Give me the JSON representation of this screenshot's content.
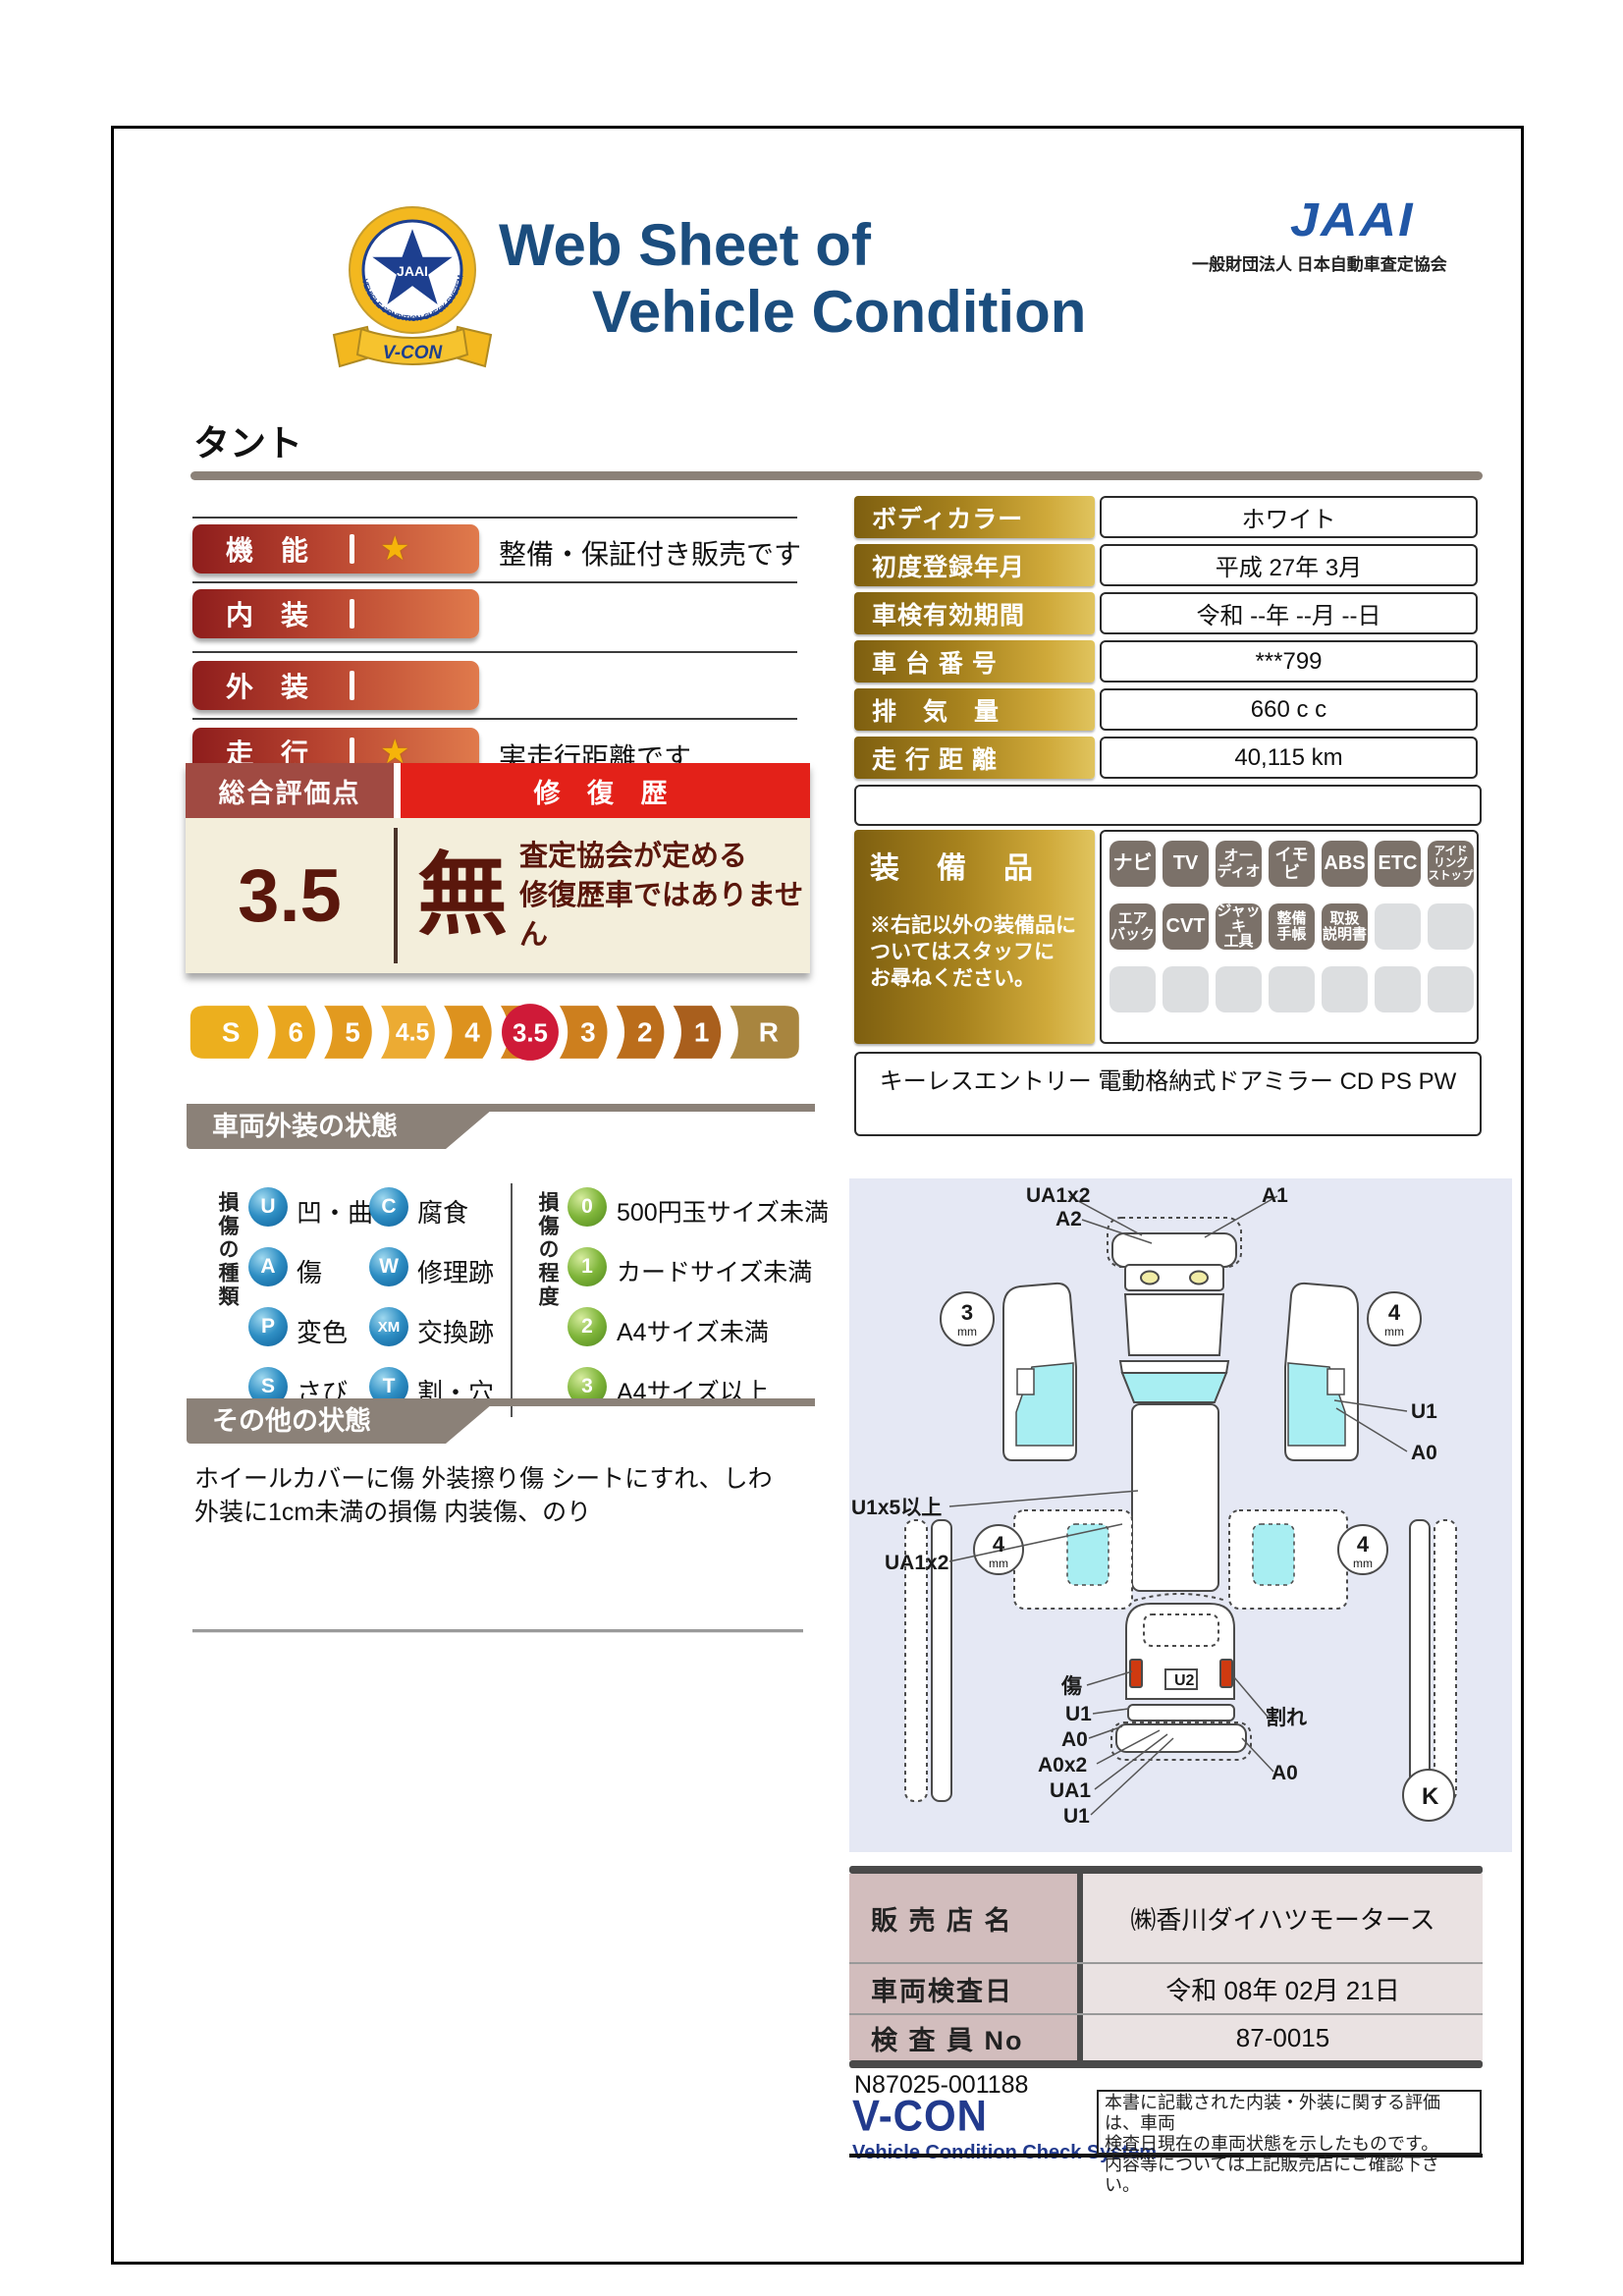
{
  "header": {
    "title_line1": "Web Sheet of",
    "title_line2": "Vehicle Condition",
    "org_logo": "JAAI",
    "org_name": "一般財団法人 日本自動車査定協会",
    "badge": {
      "star_text": "JAAI",
      "ring_text": "VEHICLE CONDITION CHECK SYSTEM",
      "ribbon": "V-CON"
    }
  },
  "vehicle_name": "タント",
  "icons": {
    "star": "★"
  },
  "ratings": [
    {
      "label": "機　能",
      "star": true,
      "note": "整備・保証付き販売です"
    },
    {
      "label": "内　装",
      "star": false,
      "note": ""
    },
    {
      "label": "外　装",
      "star": false,
      "note": ""
    },
    {
      "label": "走　行",
      "star": true,
      "note": "実走行距離です"
    }
  ],
  "overall": {
    "header_left": "総合評価点",
    "header_right": "修 復 歴",
    "score": "3.5",
    "repair": "無",
    "repair_note_line1": "査定協会が定める",
    "repair_note_line2": "修復歴車ではありません",
    "scale": [
      "S",
      "6",
      "5",
      "4.5",
      "4",
      "3.5",
      "3",
      "2",
      "1",
      "R"
    ],
    "scale_selected": "3.5"
  },
  "details": {
    "rows": [
      {
        "label": "ボディカラー",
        "value": "ホワイト"
      },
      {
        "label": "初度登録年月",
        "value": "平成 27年 3月"
      },
      {
        "label": "車検有効期間",
        "value": "令和 --年 --月 --日"
      },
      {
        "label": "車 台 番 号",
        "value": "***799"
      },
      {
        "label": "排　気　量",
        "value": "660 c c"
      },
      {
        "label": "走 行 距 離",
        "value": "40,115 km"
      }
    ]
  },
  "equipment": {
    "title": "装　備　品",
    "note_line1": "※右記以外の装備品に",
    "note_line2": "ついてはスタッフに",
    "note_line3": "お尋ねください。",
    "badges": [
      {
        "label": "ナビ",
        "active": true
      },
      {
        "label": "TV",
        "active": true
      },
      {
        "label": "オー\nディオ",
        "active": true
      },
      {
        "label": "イモビ",
        "active": true
      },
      {
        "label": "ABS",
        "active": true
      },
      {
        "label": "ETC",
        "active": true
      },
      {
        "label": "アイド\nリング\nストップ",
        "active": true
      },
      {
        "label": "エア\nバック",
        "active": true
      },
      {
        "label": "CVT",
        "active": true
      },
      {
        "label": "ジャッキ\n工具",
        "active": true
      },
      {
        "label": "整備\n手帳",
        "active": true
      },
      {
        "label": "取扱\n説明書",
        "active": true
      }
    ],
    "extra": "キーレスエントリー 電動格納式ドアミラー CD PS PW"
  },
  "exterior": {
    "section_title": "車両外装の状態",
    "types_title": "損傷の種類",
    "types": [
      {
        "code": "U",
        "label": "凹・曲"
      },
      {
        "code": "A",
        "label": "傷"
      },
      {
        "code": "P",
        "label": "変色"
      },
      {
        "code": "S",
        "label": "さび"
      },
      {
        "code": "C",
        "label": "腐食"
      },
      {
        "code": "W",
        "label": "修理跡"
      },
      {
        "code": "XM",
        "label": "交換跡"
      },
      {
        "code": "T",
        "label": "割・穴"
      }
    ],
    "levels_title": "損傷の程度",
    "levels": [
      {
        "code": "0",
        "label": "500円玉サイズ未満"
      },
      {
        "code": "1",
        "label": "カードサイズ未満"
      },
      {
        "code": "2",
        "label": "A4サイズ未満"
      },
      {
        "code": "3",
        "label": "A4サイズ以上"
      }
    ]
  },
  "other": {
    "section_title": "その他の状態",
    "line1": "ホイールカバーに傷 外装擦り傷 シートにすれ、しわ",
    "line2": "外装に1cm未満の損傷 内装傷、のり"
  },
  "diagram": {
    "labels": {
      "top_a": "UA1x2",
      "top_b": "A2",
      "top_c": "A1",
      "left_a": "U1x5以上",
      "left_b": "UA1x2",
      "right_a": "U1",
      "right_b": "A0",
      "rear_a": "傷",
      "rear_b": "U1",
      "rear_c": "A0",
      "rear_d": "A0x2",
      "rear_e": "UA1",
      "rear_f": "U1",
      "rear_g": "割れ",
      "rear_h": "A0"
    },
    "plate": "U2",
    "corner": "K",
    "tires": {
      "front_left": "3",
      "front_right": "4",
      "rear_left": "4",
      "rear_right": "4",
      "unit": "mm"
    }
  },
  "dealer": {
    "rows": [
      {
        "label": "販 売 店 名",
        "value": "㈱香川ダイハツモータース"
      },
      {
        "label": "車両検査日",
        "value": "令和 08年 02月 21日"
      },
      {
        "label": "検 査 員 No",
        "value": "87-0015"
      }
    ]
  },
  "footer": {
    "doc_no": "N87025-001188",
    "brand": "V-CON",
    "brand_sub": "Vehicle Condition Check System",
    "disclaimer_line1": "本書に記載された内装・外装に関する評価は、車両",
    "disclaimer_line2": "検査日現在の車両状態を示したものです。",
    "disclaimer_line3": "内容等については上記販売店にご確認下さい。"
  }
}
